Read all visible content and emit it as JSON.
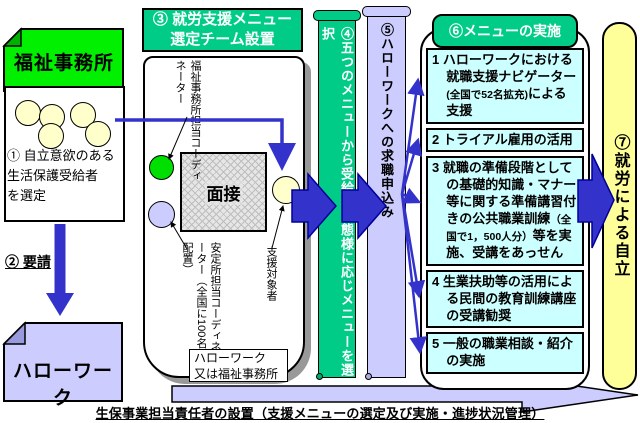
{
  "colors": {
    "bright_green": "#00F000",
    "teal": "#00CC88",
    "lavender": "#CCCCFF",
    "cyan": "#CCFFFF",
    "pale_yellow": "#FFFF99",
    "royal_blue": "#3333CC",
    "person_circle": "#FFFFCC"
  },
  "left_panel": {
    "welfare_office_label": "福祉事務所",
    "step1_text": "① 自立意欲のある\n生活保護受給者\nを選定",
    "step2_label": "② 要請",
    "hellowork_label": "ハローワーク"
  },
  "team_panel": {
    "header": "③ 就労支援メニュー\n選定チーム設置",
    "welfare_coordinator_label": "福祉事務所担当コーディネーター",
    "stability_coordinator_label": "安定所担当コーディネーター（全国に100名配置）",
    "interview_label": "面接",
    "support_target_label": "支援対象者",
    "location_note": "ハローワーク\n又は福祉事務所"
  },
  "banner_select_label": "④五つのメニューから受給者の態様に応じメニューを選択",
  "banner_apply_label": "⑤ハローワークへの求職申込み",
  "menu_panel": {
    "header": "⑥メニューの実施",
    "items": [
      {
        "pre": "1 ハローワークにおける就職支援ナビゲーター",
        "small": "(全国で52名拡充)",
        "post": "による支援"
      },
      {
        "pre": "2 トライアル雇用の活用",
        "small": "",
        "post": ""
      },
      {
        "pre": "3 就職の準備段階としての基礎的知識・マナー等に関する準備講習付きの公共職業訓練",
        "small": "（全国で1，500人分）",
        "post": "等を実施、受講をあっせん"
      },
      {
        "pre": "4 生業扶助等の活用による民間の教育訓練講座の受講勧奨",
        "small": "",
        "post": ""
      },
      {
        "pre": "5 一般の職業相談・紹介の実施",
        "small": "",
        "post": ""
      }
    ]
  },
  "goal_label": "⑦就労による自立",
  "footer_note": "生保事業担当責任者の設置（支援メニューの選定及び実施・進捗状況管理）"
}
